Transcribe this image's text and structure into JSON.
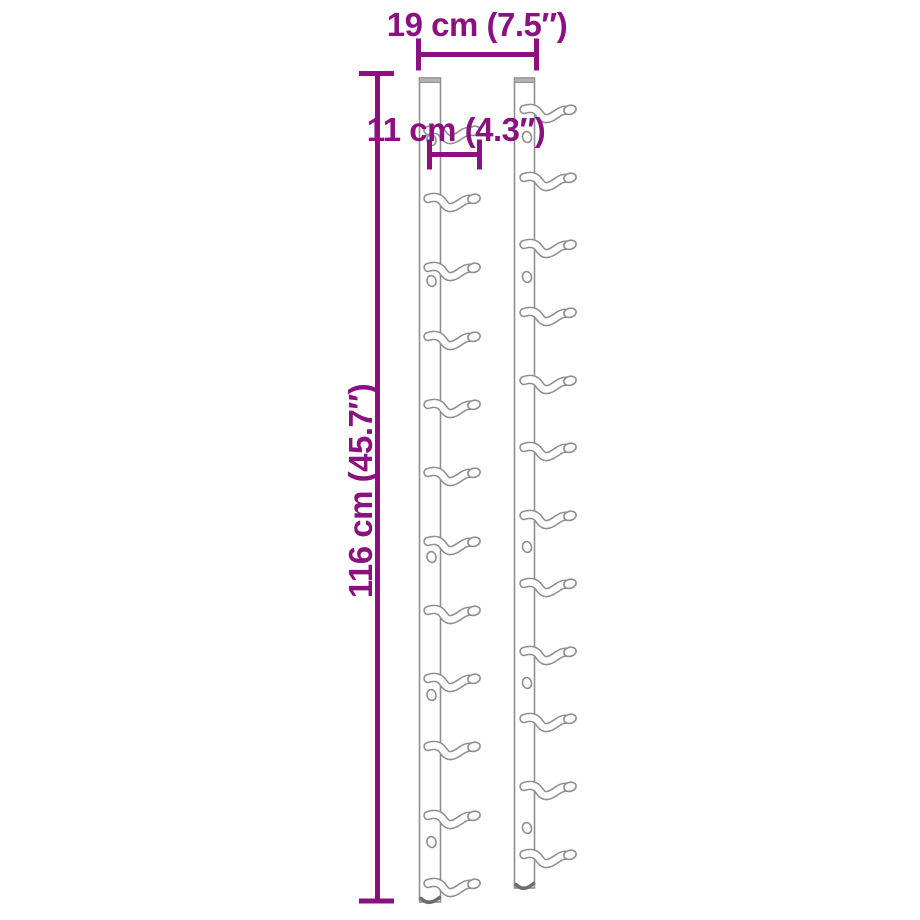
{
  "diagram": {
    "subject": "wall-mounted wine rack — two vertical rails with bottle hooks",
    "labels": {
      "width": "19 cm (7.5″)",
      "hook_width": "11 cm (4.3″)",
      "height": "116 cm (45.7″)"
    },
    "colors": {
      "dimension_accent": "#8B1180",
      "object_outline": "#8F8F8F",
      "object_fill": "#FFFFFF",
      "background": "#FFFFFF"
    },
    "structure": {
      "rail_count": 2,
      "hooks_per_rail": 12,
      "screw_holes_per_rail": 5
    }
  }
}
